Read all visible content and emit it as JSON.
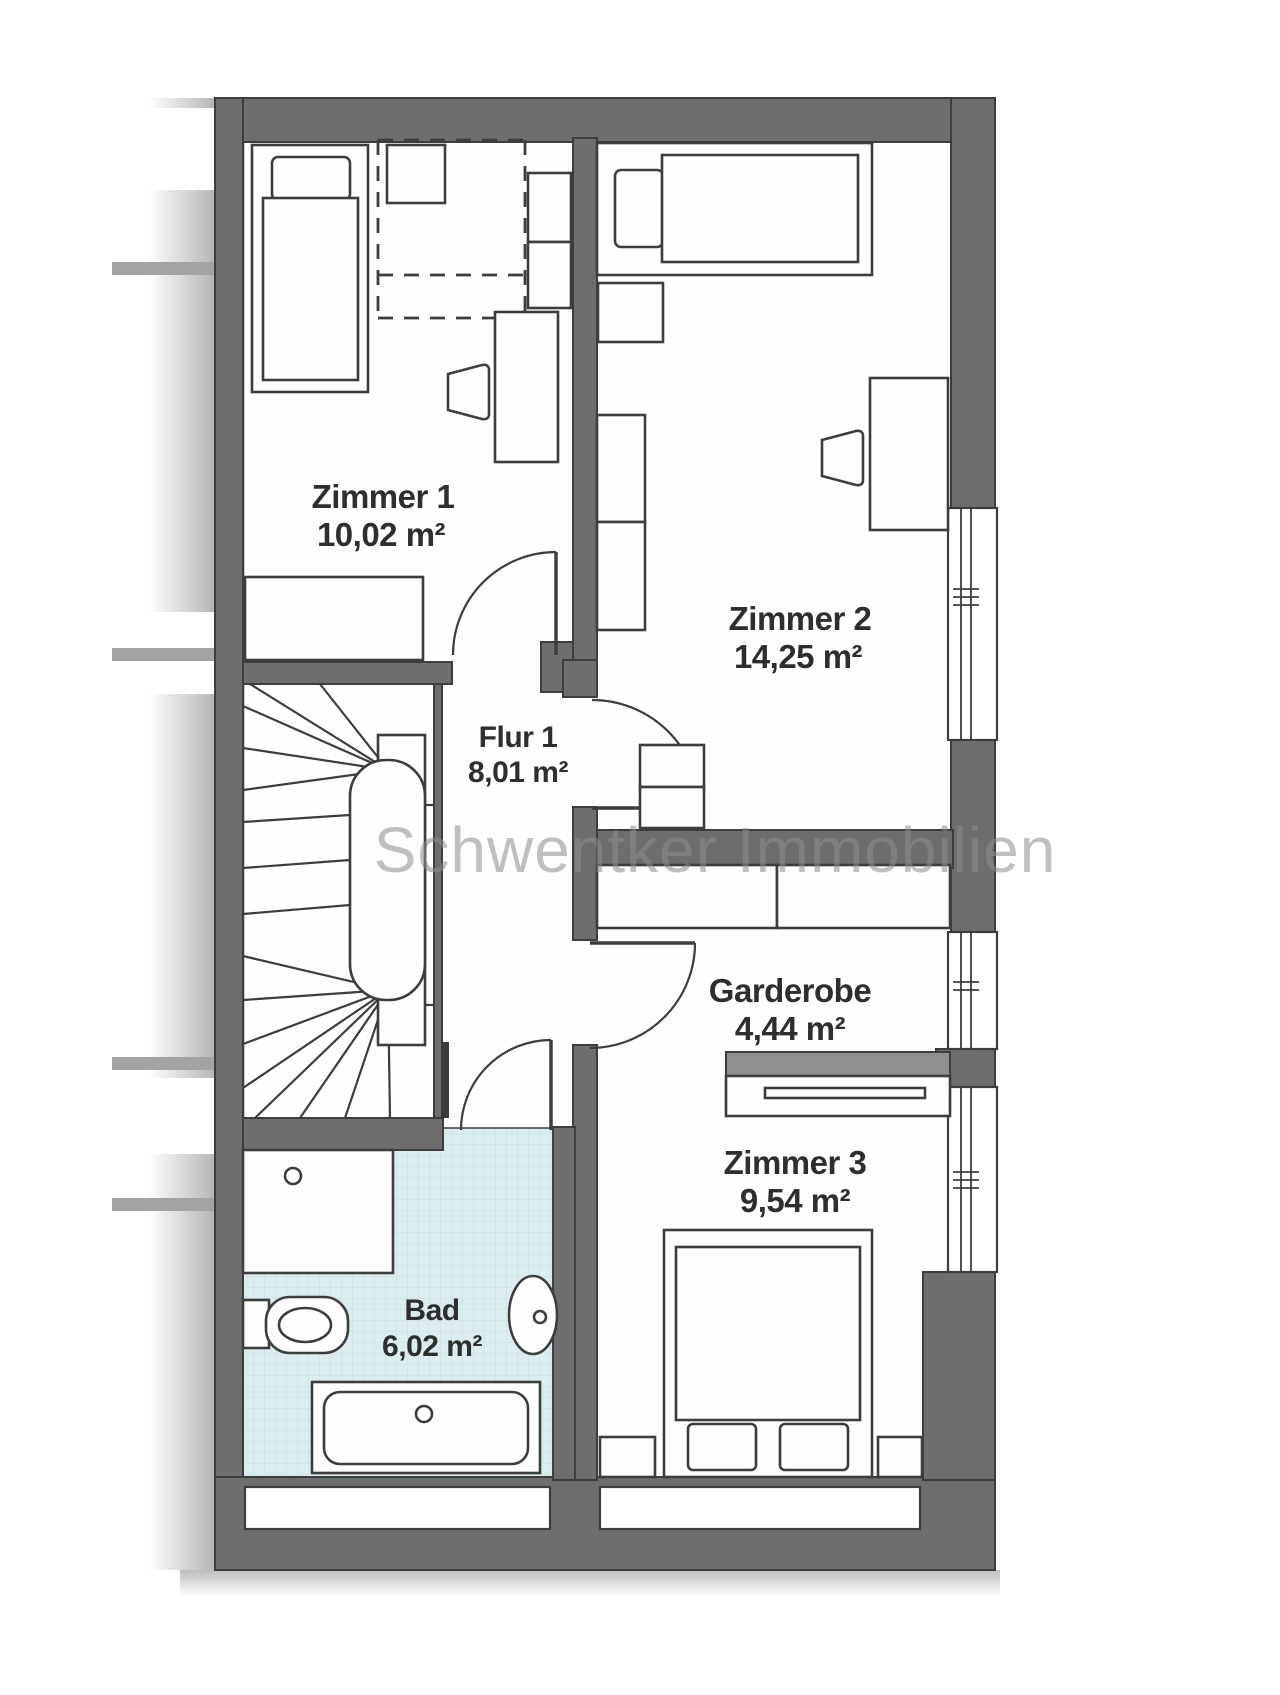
{
  "watermark": "Schwentker Immobilien",
  "rooms": {
    "zimmer1": {
      "name": "Zimmer 1",
      "area": "10,02 m²"
    },
    "zimmer2": {
      "name": "Zimmer 2",
      "area": "14,25 m²"
    },
    "flur1": {
      "name": "Flur 1",
      "area": "8,01 m²"
    },
    "garderobe": {
      "name": "Garderobe",
      "area": "4,44 m²"
    },
    "zimmer3": {
      "name": "Zimmer 3",
      "area": "9,54 m²"
    },
    "bad": {
      "name": "Bad",
      "area": "6,02 m²"
    }
  },
  "colors": {
    "wall": "#6e6e6e",
    "wall_outline": "#3d3d3d",
    "tile": "#dcedef",
    "tile_grid": "#c3dfe2",
    "watermark": "#8d8d8d",
    "label": "#2e2e2e",
    "background": "#ffffff"
  }
}
